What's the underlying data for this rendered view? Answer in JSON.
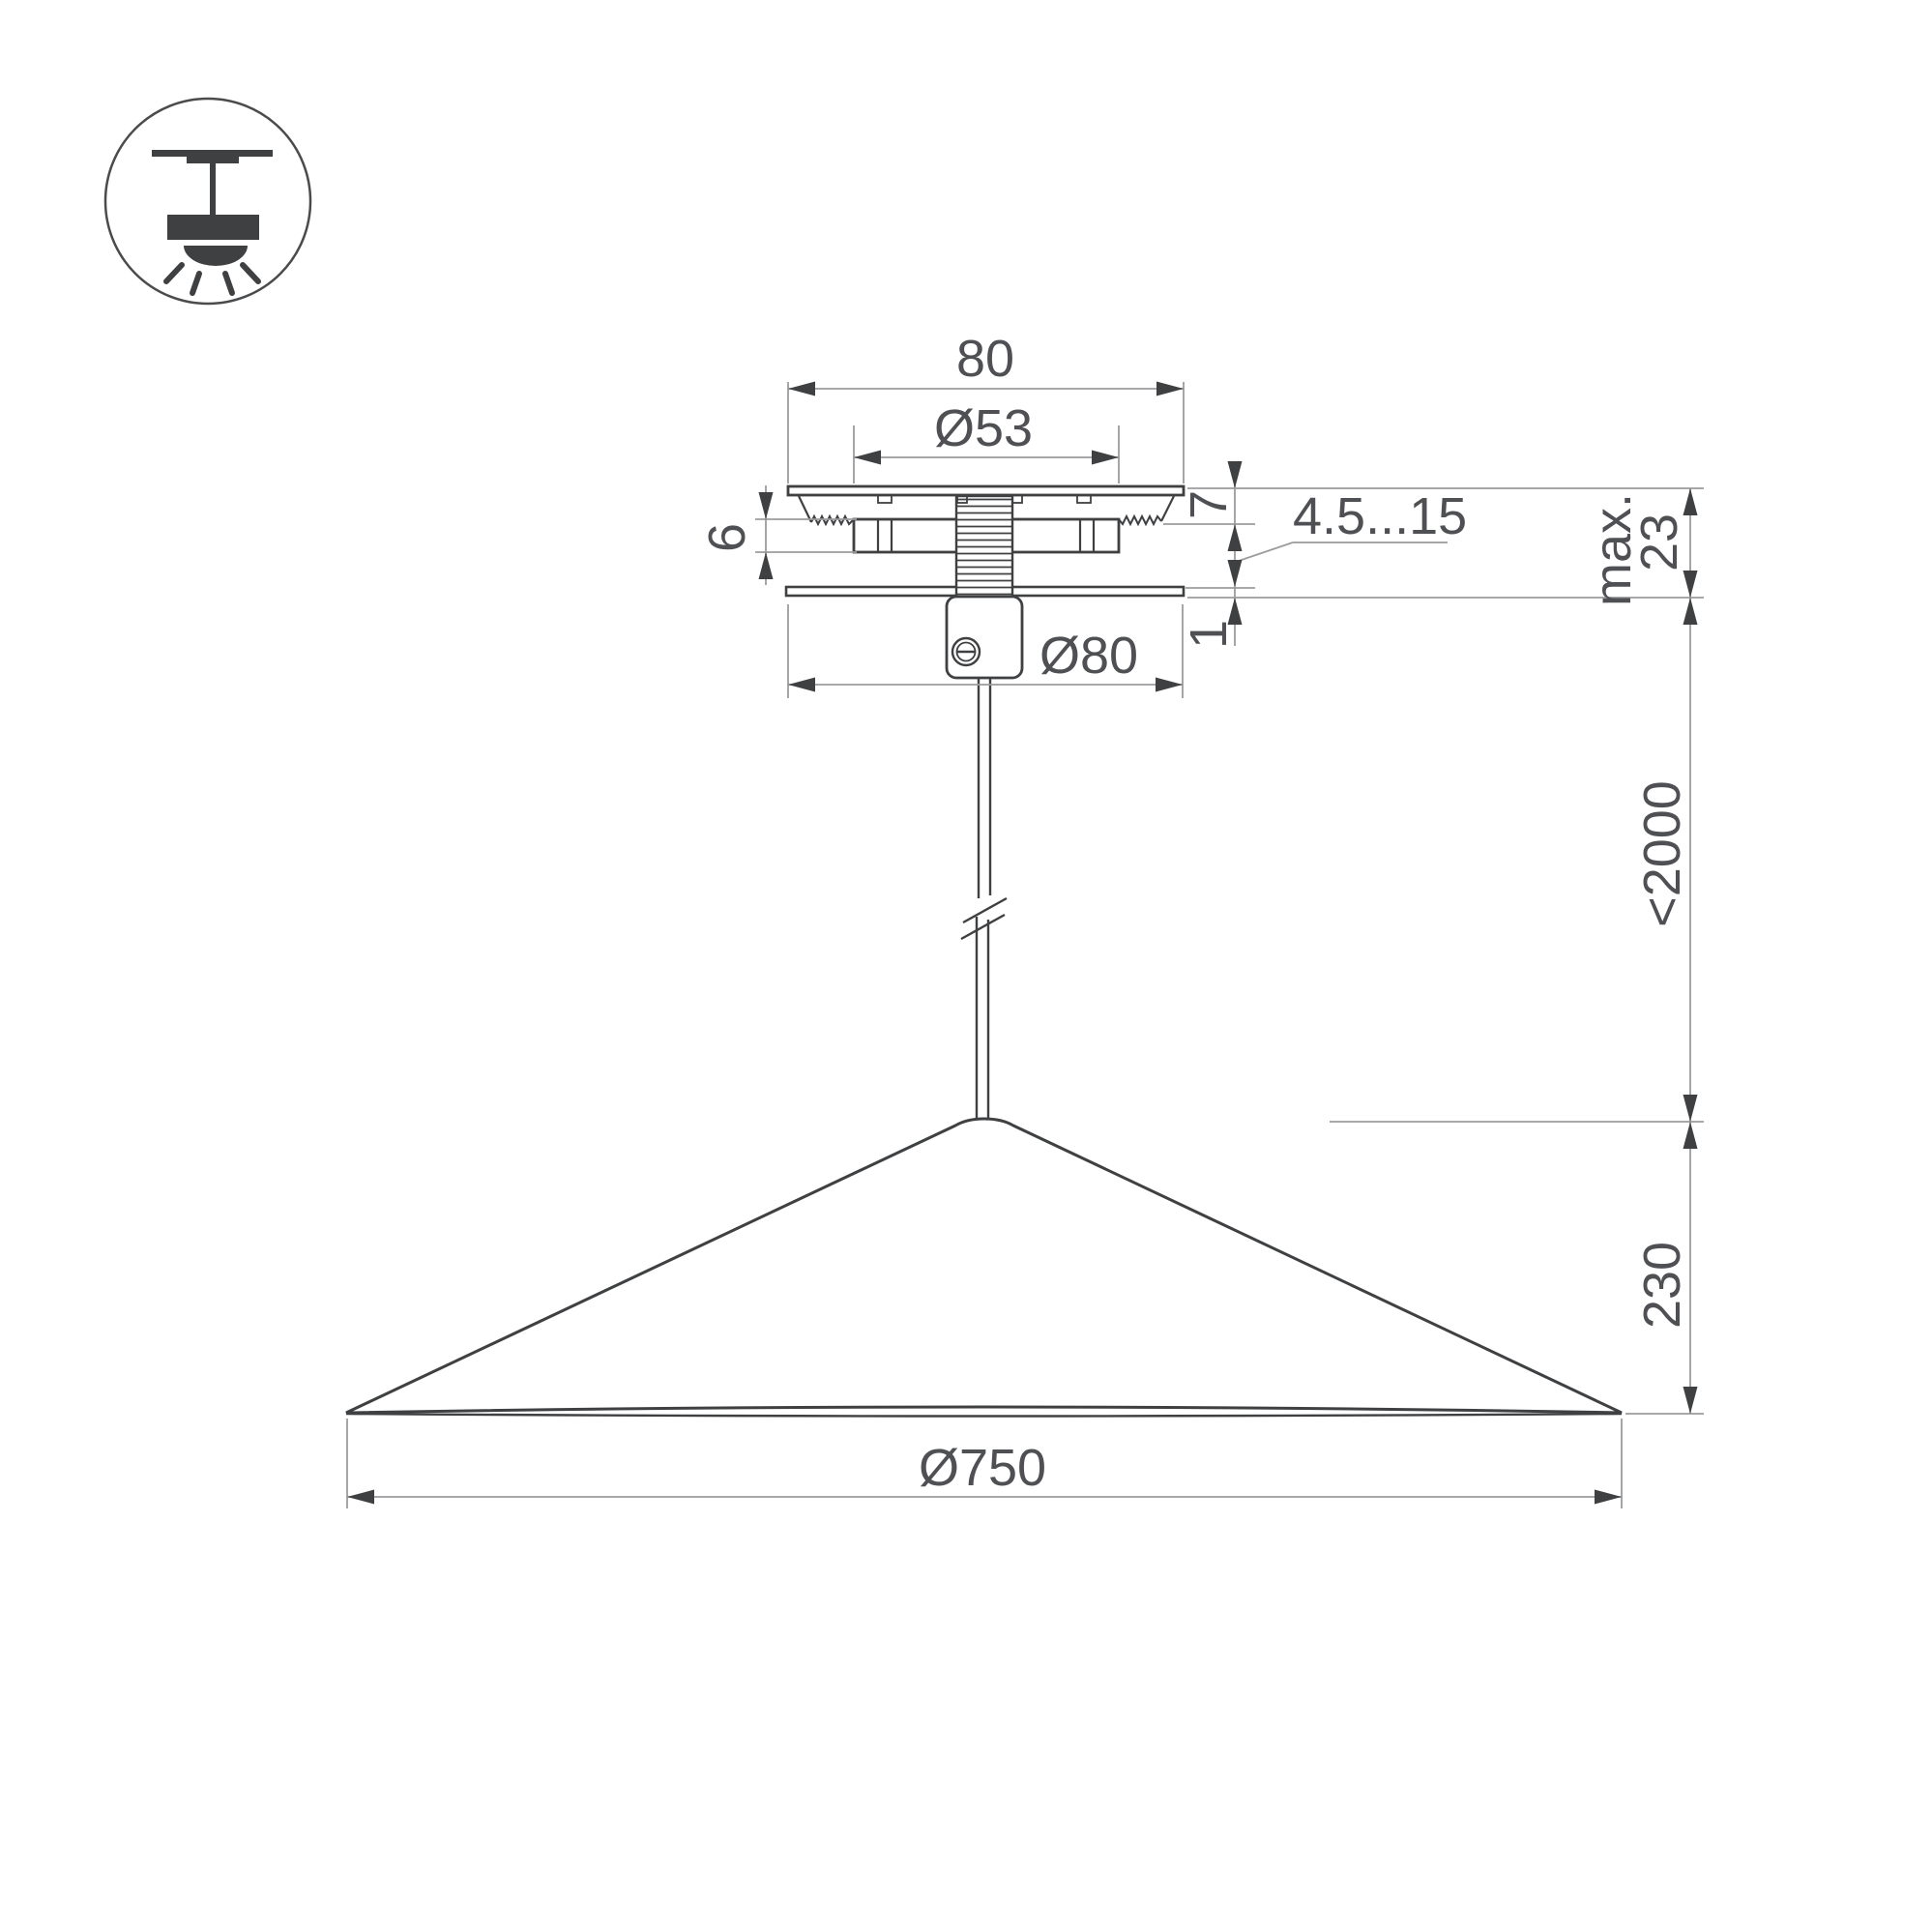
{
  "drawing": {
    "type": "pendant-lamp-dimension-drawing",
    "background": "#ffffff",
    "colors": {
      "object_line": "#3f4042",
      "dimension_line": "#9c9c9e",
      "text": "#4f5054"
    },
    "icon": {
      "name": "ceiling-pendant-light-icon",
      "meaning": "surface ceiling mount pendant luminaire"
    },
    "dimensions": {
      "canopy_width": "80",
      "hole_diameter": "Ø53",
      "bracket_height": "6",
      "canopy_top_height": "7",
      "mount_thickness_range": "4.5...15",
      "plate_thickness": "1",
      "canopy_diameter": "Ø80",
      "recess_max_label": "max.",
      "recess_max_value": "23",
      "suspension_length": "<2000",
      "shade_height": "230",
      "shade_diameter": "Ø750"
    }
  }
}
